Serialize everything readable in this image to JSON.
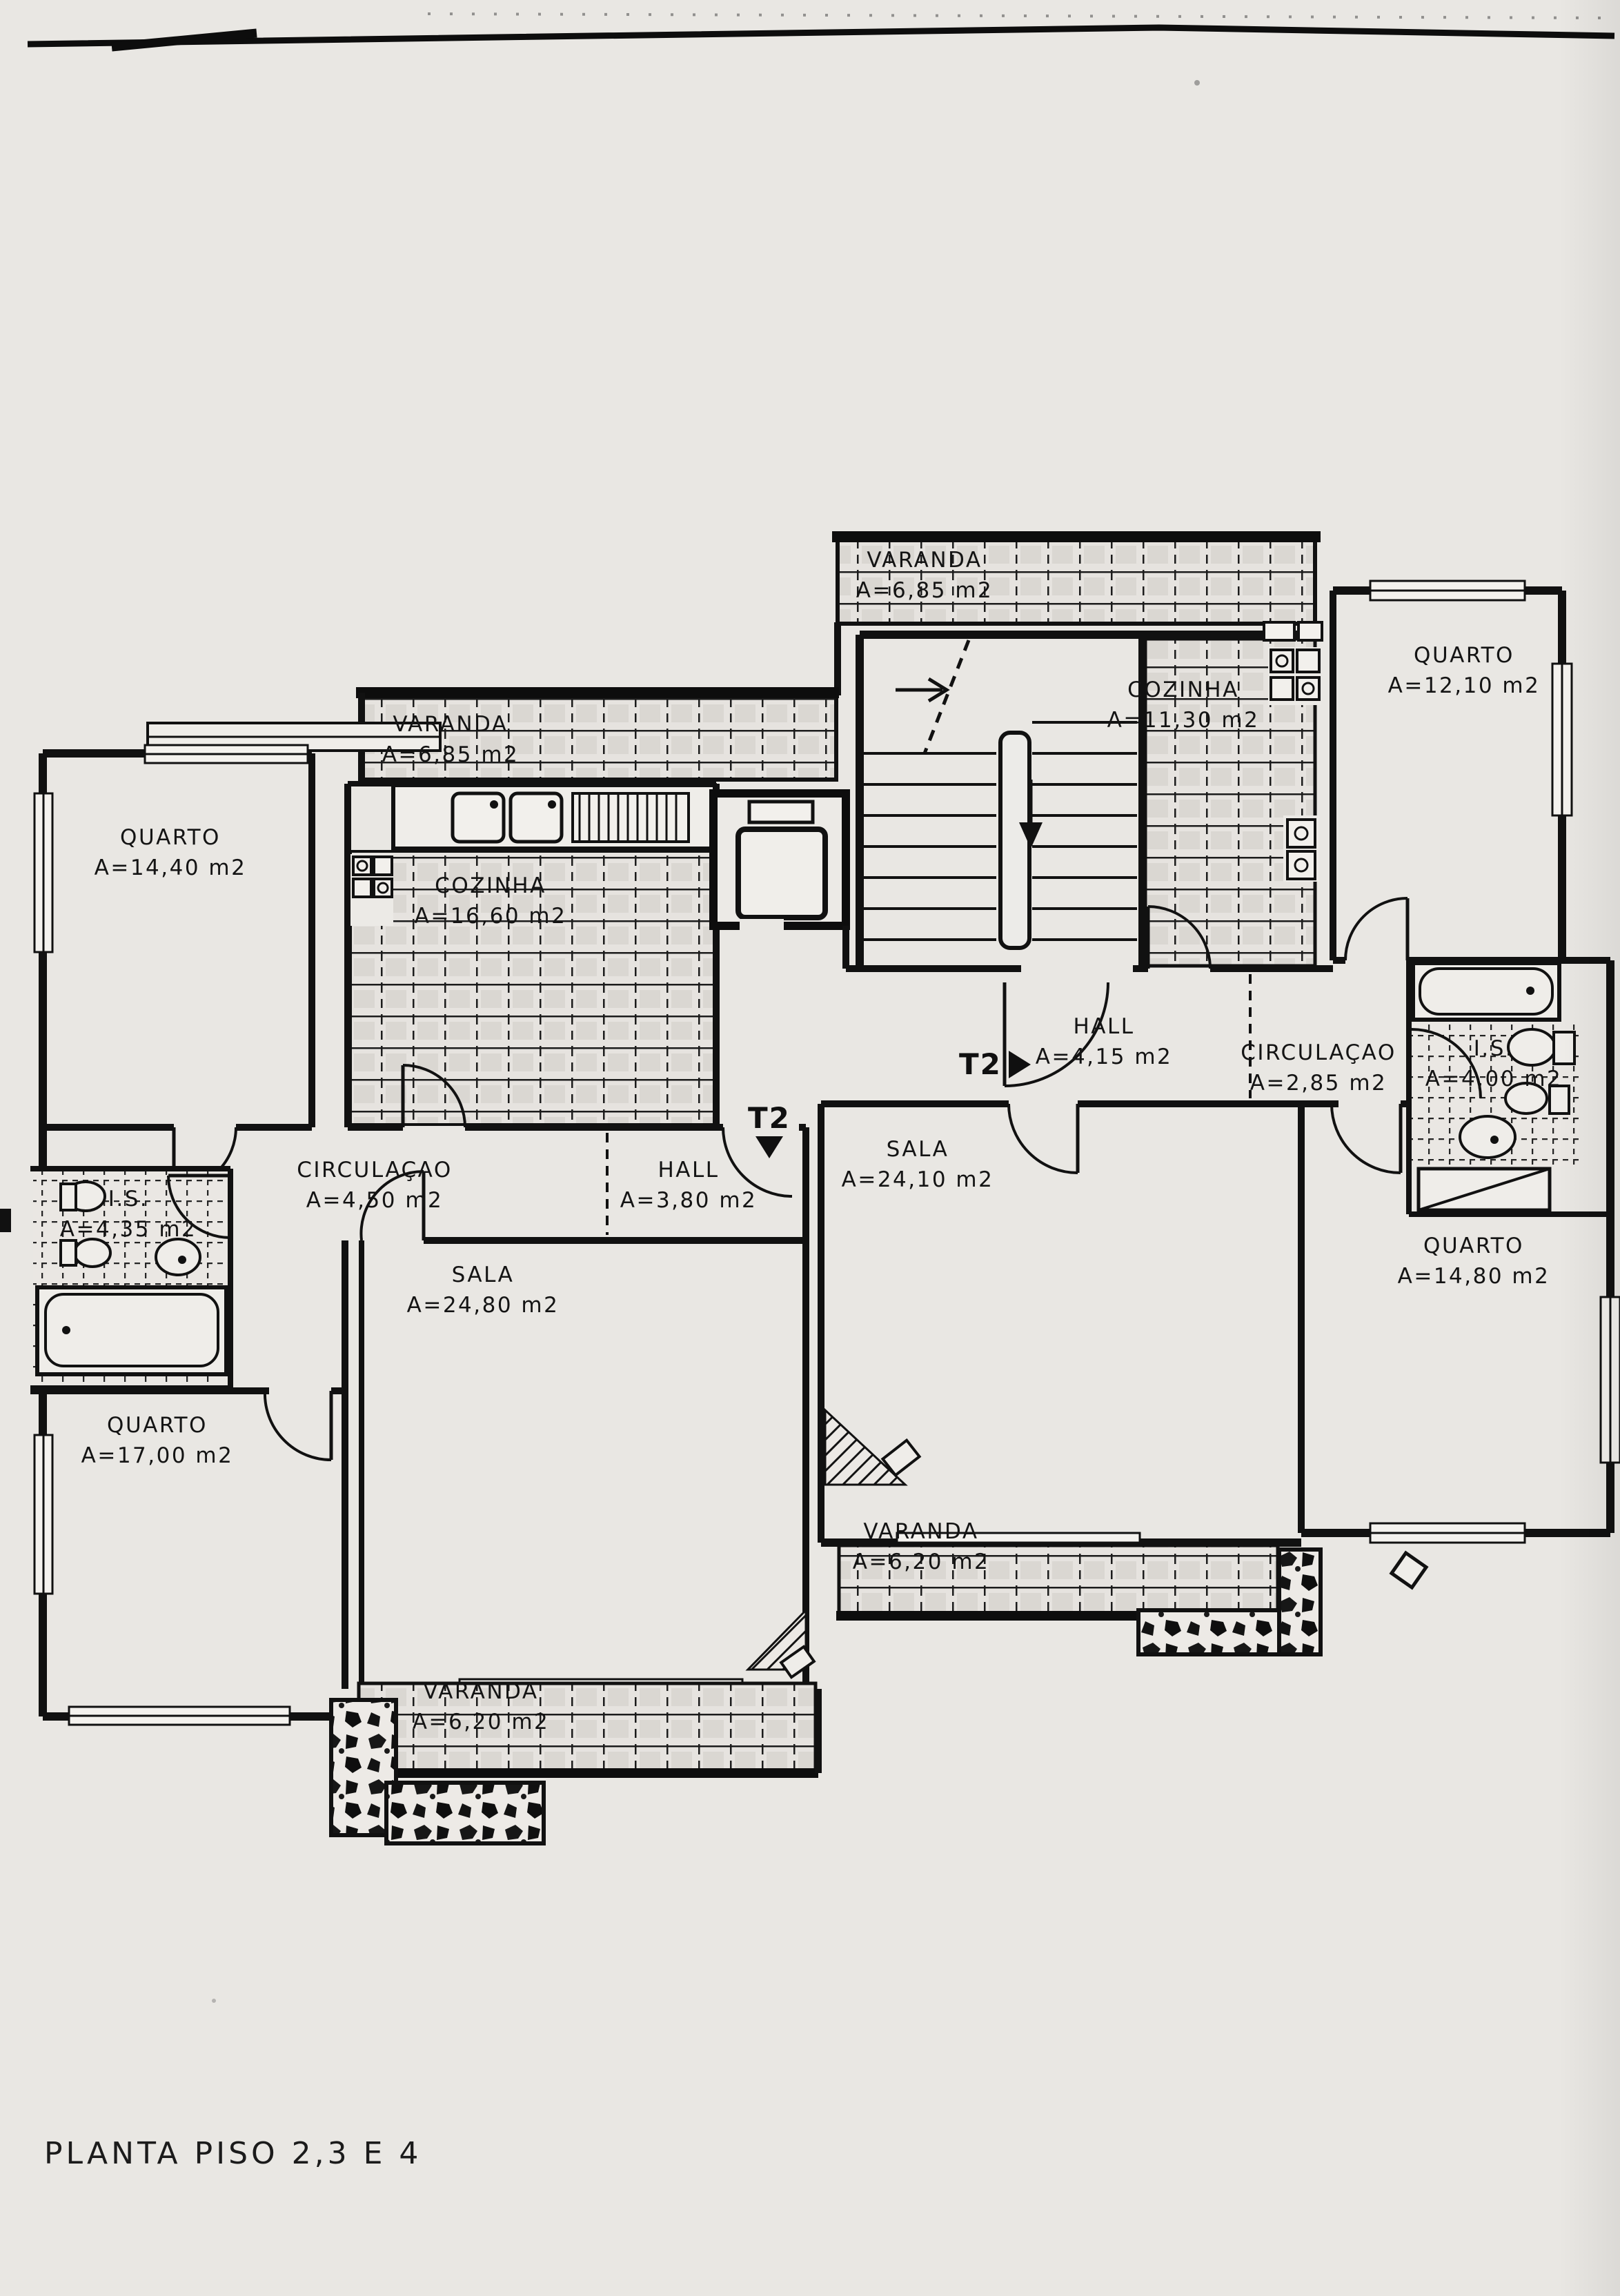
{
  "page": {
    "title": "PLANTA PISO 2,3 E 4"
  },
  "plan": {
    "rooms": [
      {
        "name": "VARANDA",
        "area": "A=6,85 m2"
      },
      {
        "name": "COZINHA",
        "area": "A=11,30 m2"
      },
      {
        "name": "QUARTO",
        "area": "A=12,10 m2"
      },
      {
        "name": "QUARTO",
        "area": "A=14,40 m2"
      },
      {
        "name": "VARANDA",
        "area": "A=6,85 m2"
      },
      {
        "name": "COZINHA",
        "area": "A=16,60 m2"
      },
      {
        "name": "HALL",
        "area": "A=4,15 m2"
      },
      {
        "name": "CIRCULAÇAO",
        "area": "A=2,85 m2"
      },
      {
        "name": "I.S.",
        "area": "A=4,00 m2"
      },
      {
        "name": "CIRCULAÇAO",
        "area": "A=4,50 m2"
      },
      {
        "name": "HALL",
        "area": "A=3,80 m2"
      },
      {
        "name": "SALA",
        "area": "A=24,10 m2"
      },
      {
        "name": "I.S.",
        "area": "A=4,35 m2"
      },
      {
        "name": "SALA",
        "area": "A=24,80 m2"
      },
      {
        "name": "QUARTO",
        "area": "A=14,80 m2"
      },
      {
        "name": "QUARTO",
        "area": "A=17,00 m2"
      },
      {
        "name": "VARANDA",
        "area": "A=6,20 m2"
      },
      {
        "name": "VARANDA",
        "area": "A=6,20 m2"
      }
    ],
    "unit_markers": [
      {
        "label": "T2",
        "direction": "right"
      },
      {
        "label": "T2",
        "direction": "down"
      }
    ]
  }
}
